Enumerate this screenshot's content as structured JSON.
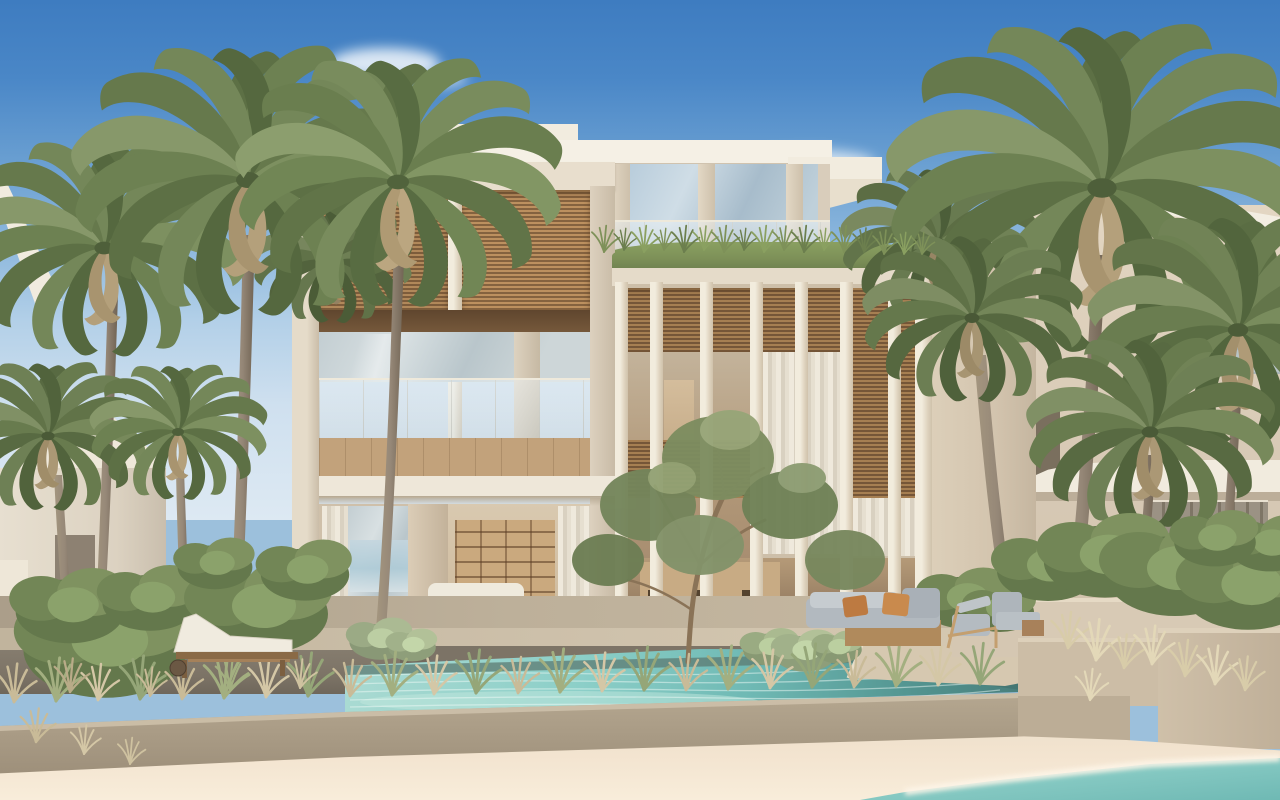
{
  "meta": {
    "title": "Architectural rendering of a three-storey modern beachfront villa with palm trees, infinity pool and white-sand shoreline",
    "width_px": 1280,
    "height_px": 800
  },
  "scene": {
    "sky": {
      "label": "clear blue sky with thin white clouds",
      "top_color": "#3e7cc0",
      "horizon_color": "#cfe0ef"
    },
    "clouds": {
      "label": "wispy white clouds",
      "color": "#ffffff"
    },
    "background_left_villa": {
      "label": "neighbouring villa with white pitched roofs on the left",
      "wall_color": "#e3dbcb",
      "roof_color": "#f1ebdf"
    },
    "background_right_building": {
      "label": "neighbouring cream building with white balcony band on the right",
      "wall_color": "#d9cbb7",
      "fascia_color": "#f3eee2"
    },
    "mid_wall": {
      "label": "cream garden wall between the villas",
      "color": "#d3c4ae"
    },
    "main_villa": {
      "label": "three-storey modern beach villa in cream stone with timber louvre screens and glass balustrades",
      "stone_color": "#ddd2c0",
      "fascia_color": "#f5f0e5",
      "louvre_wood_color": "#a87f53",
      "balcony_wood_color": "#c2a27b",
      "glass_color": "#c6d3d9",
      "floors": [
        {
          "label": "set-back roof level with glass balustrade and grass planter edge"
        },
        {
          "label": "first floor with timber louvre panels, balcony and glass balustrade"
        },
        {
          "label": "ground floor living room opening to the pool deck through sheer curtains"
        }
      ]
    },
    "vertical_fins": {
      "label": "full-height stone fin screen on the right wing",
      "count_visible": 8,
      "color": "#e8dfcf"
    },
    "roof_grass": {
      "label": "ornamental grass fringe on the terrace edges",
      "color": "#7d9058"
    },
    "olive_tree": {
      "label": "olive tree beside the pool",
      "foliage_color": "#7a8a5f",
      "trunk_color": "#8a7357"
    },
    "palm_trees": {
      "label": "coconut and date palms framing the villa on both sides",
      "count_visible": 11,
      "frond_colors": [
        "#55683f",
        "#6d8152",
        "#87986a"
      ],
      "trunk_color": "#9a8c79"
    },
    "terrace": {
      "label": "stone pool deck with dark paver band",
      "deck_color": "#c8bba4",
      "dark_paver_color": "#7c7366"
    },
    "interior": {
      "label": "glimpse of living room with shelving unit, white sofa and dining set",
      "wood_color": "#b0895e",
      "sofa_color": "#f1ece0"
    },
    "pool": {
      "label": "turquoise infinity pool along the terrace",
      "water_colors": [
        "#a9dad2",
        "#6fb9b4",
        "#497f7c"
      ]
    },
    "pool_wall": {
      "label": "raised rough-stone pool wall above the beach",
      "color": "#a89a85"
    },
    "grasses": {
      "label": "dry ornamental grasses along the pool edge and planters",
      "colors": [
        "#c9bb98",
        "#a3af80",
        "#d8cca9"
      ]
    },
    "shrubs": {
      "label": "green shrubs in stepped stone planters",
      "colors": [
        "#64784c",
        "#7f9260"
      ]
    },
    "planters": {
      "label": "stepped cream stone planter boxes on the right",
      "color": "#c9baa3"
    },
    "furniture": {
      "sun_lounger": {
        "label": "timber sun lounger with white cushion on the left terrace",
        "cushion_color": "#f1ece0",
        "frame_color": "#8a6a46"
      },
      "day_bed": {
        "label": "grey day-bed sofa with rust cushions on the right terrace",
        "cushion_color": "#b2b9bf",
        "pillow_color": "#c27f45",
        "base_color": "#b08a5c"
      },
      "lounge_chair": {
        "label": "timber-frame lounge chair beside the day-bed",
        "frame_color": "#c49f6f"
      }
    },
    "beach": {
      "label": "white sand beach in the foreground",
      "sand_color": "#f0e3cf"
    },
    "sea": {
      "label": "turquoise shoreline water entering at the bottom right",
      "water_color": "#7ec7c2",
      "foam_color": "#fdf5e8"
    }
  }
}
